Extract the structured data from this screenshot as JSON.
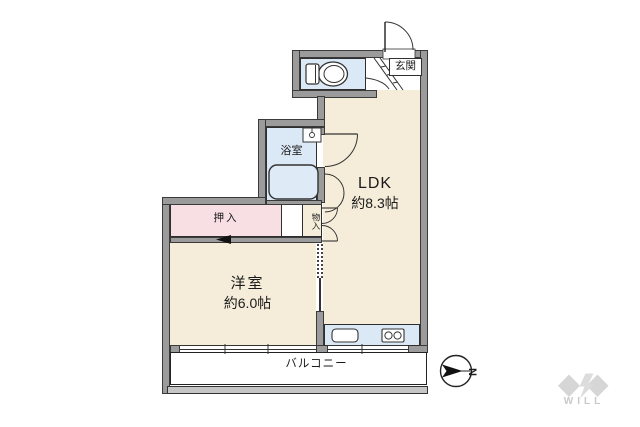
{
  "plan": {
    "rooms": {
      "entrance_label": "玄関",
      "bathroom_label": "浴室",
      "ldk_label": "LDK",
      "ldk_size": "約8.3帖",
      "western_room_label": "洋室",
      "western_room_size": "約6.0帖",
      "closet_label": "押入",
      "storage_label": "物入",
      "balcony_label": "バルコニー"
    },
    "fixtures": [
      "toilet",
      "bathtub",
      "washbasin",
      "kitchen-sink",
      "stove"
    ],
    "compass": {
      "north_label": "N",
      "direction": "north-points-right"
    },
    "branding": {
      "logo_text": "WILL"
    }
  },
  "colors": {
    "wall": "#9b9b9b",
    "wall_outline": "#3a3a3a",
    "floor": "#f5ecd9",
    "closet_pink": "#f8dfe4",
    "wet_blue": "#dbe8f5",
    "tub_blue": "#dfeaf7",
    "balcony_bar": "#c6c6c6",
    "logo_gray": "#d6d6d6",
    "text": "#1b1b1b"
  }
}
